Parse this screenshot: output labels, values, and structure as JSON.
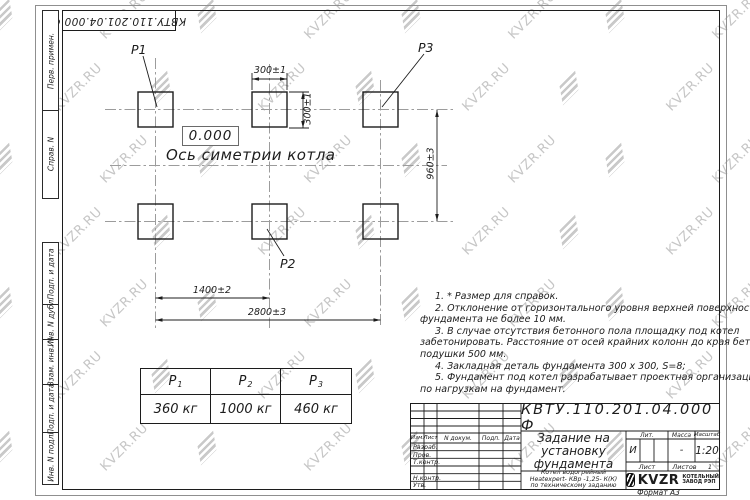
{
  "watermark": {
    "text": "KVZR.RU"
  },
  "top_stamp": {
    "text": "КВТУ.110.201.04.000  Ф"
  },
  "frame_labels": {
    "perv": "Перв. примен.",
    "sprav": "Справ. N",
    "podp_data_1": "Подп. и дата",
    "inv_dubl": "Инв. N дубл.",
    "vzam_inv": "Взам. инв. N",
    "podp_data_2": "Подп. и дата",
    "inv_podl": "Инв. N подл."
  },
  "drawing": {
    "p1": "P1",
    "p2": "P2",
    "p3": "P3",
    "elevation": "0.000",
    "axis_label": "Ось симетрии котла",
    "dim_width": "300±1",
    "dim_height": "300±1",
    "dim_row_spacing": "960±3",
    "dim_col_spacing": "1400±2",
    "dim_total": "2800±3"
  },
  "notes": {
    "lines": [
      "1.  * Размер для справок.",
      "2.  Отклонение от горизонтального уровня верхней поверхности",
      "фундамента не более 10 мм.",
      "3.  В случае отсутствия бетонного пола площадку под котел",
      "забетонировать. Расстояние от осей крайних колонн до края бетонной",
      "подушки 500 мм.",
      "4.  Закладная деталь фундамента  300 х 300, S=8;",
      "5.  Фундамент под котел разрабатывает проектная организация",
      "по нагрузкам на фундамент."
    ]
  },
  "load_table": {
    "cols": [
      {
        "head": "P",
        "sub": "1",
        "value": "360  кг"
      },
      {
        "head": "P",
        "sub": "2",
        "value": "1000 кг"
      },
      {
        "head": "P",
        "sub": "3",
        "value": "460  кг"
      }
    ]
  },
  "title_block": {
    "doc_number": "КВТУ.110.201.04.000  Ф",
    "title_line1": "Задание на",
    "title_line2": "установку",
    "title_line3": "фундамента",
    "subtitle_line1": "Котел водогрейный",
    "subtitle_line2": "Heatexpert- КВр -1,25- К(К)",
    "subtitle_line3": "по техническому заданию",
    "col_izm": "Изм.",
    "col_list": "Лист",
    "col_dokum": "N докум.",
    "col_podp": "Подп.",
    "col_data": "Дата",
    "row_razrab": "Разраб.",
    "row_prov": "Пров.",
    "row_tkontr": "Т.контр.",
    "row_nkontr": "Н.контр.",
    "row_utv": "Утв.",
    "lit_label": "Лит.",
    "massa_label": "Масса",
    "masshtab_label": "Масштаб",
    "lit_value": "И",
    "massa_value": "-",
    "masshtab_value": "1:20",
    "list_label": "Лист",
    "listov_label": "Листов",
    "listov_value": "1",
    "logo_text": "KVZR",
    "logo_sub1": "КОТЕЛЬНЫЙ",
    "logo_sub2": "ЗАВОД РЭП",
    "format_label": "Формат А3"
  }
}
